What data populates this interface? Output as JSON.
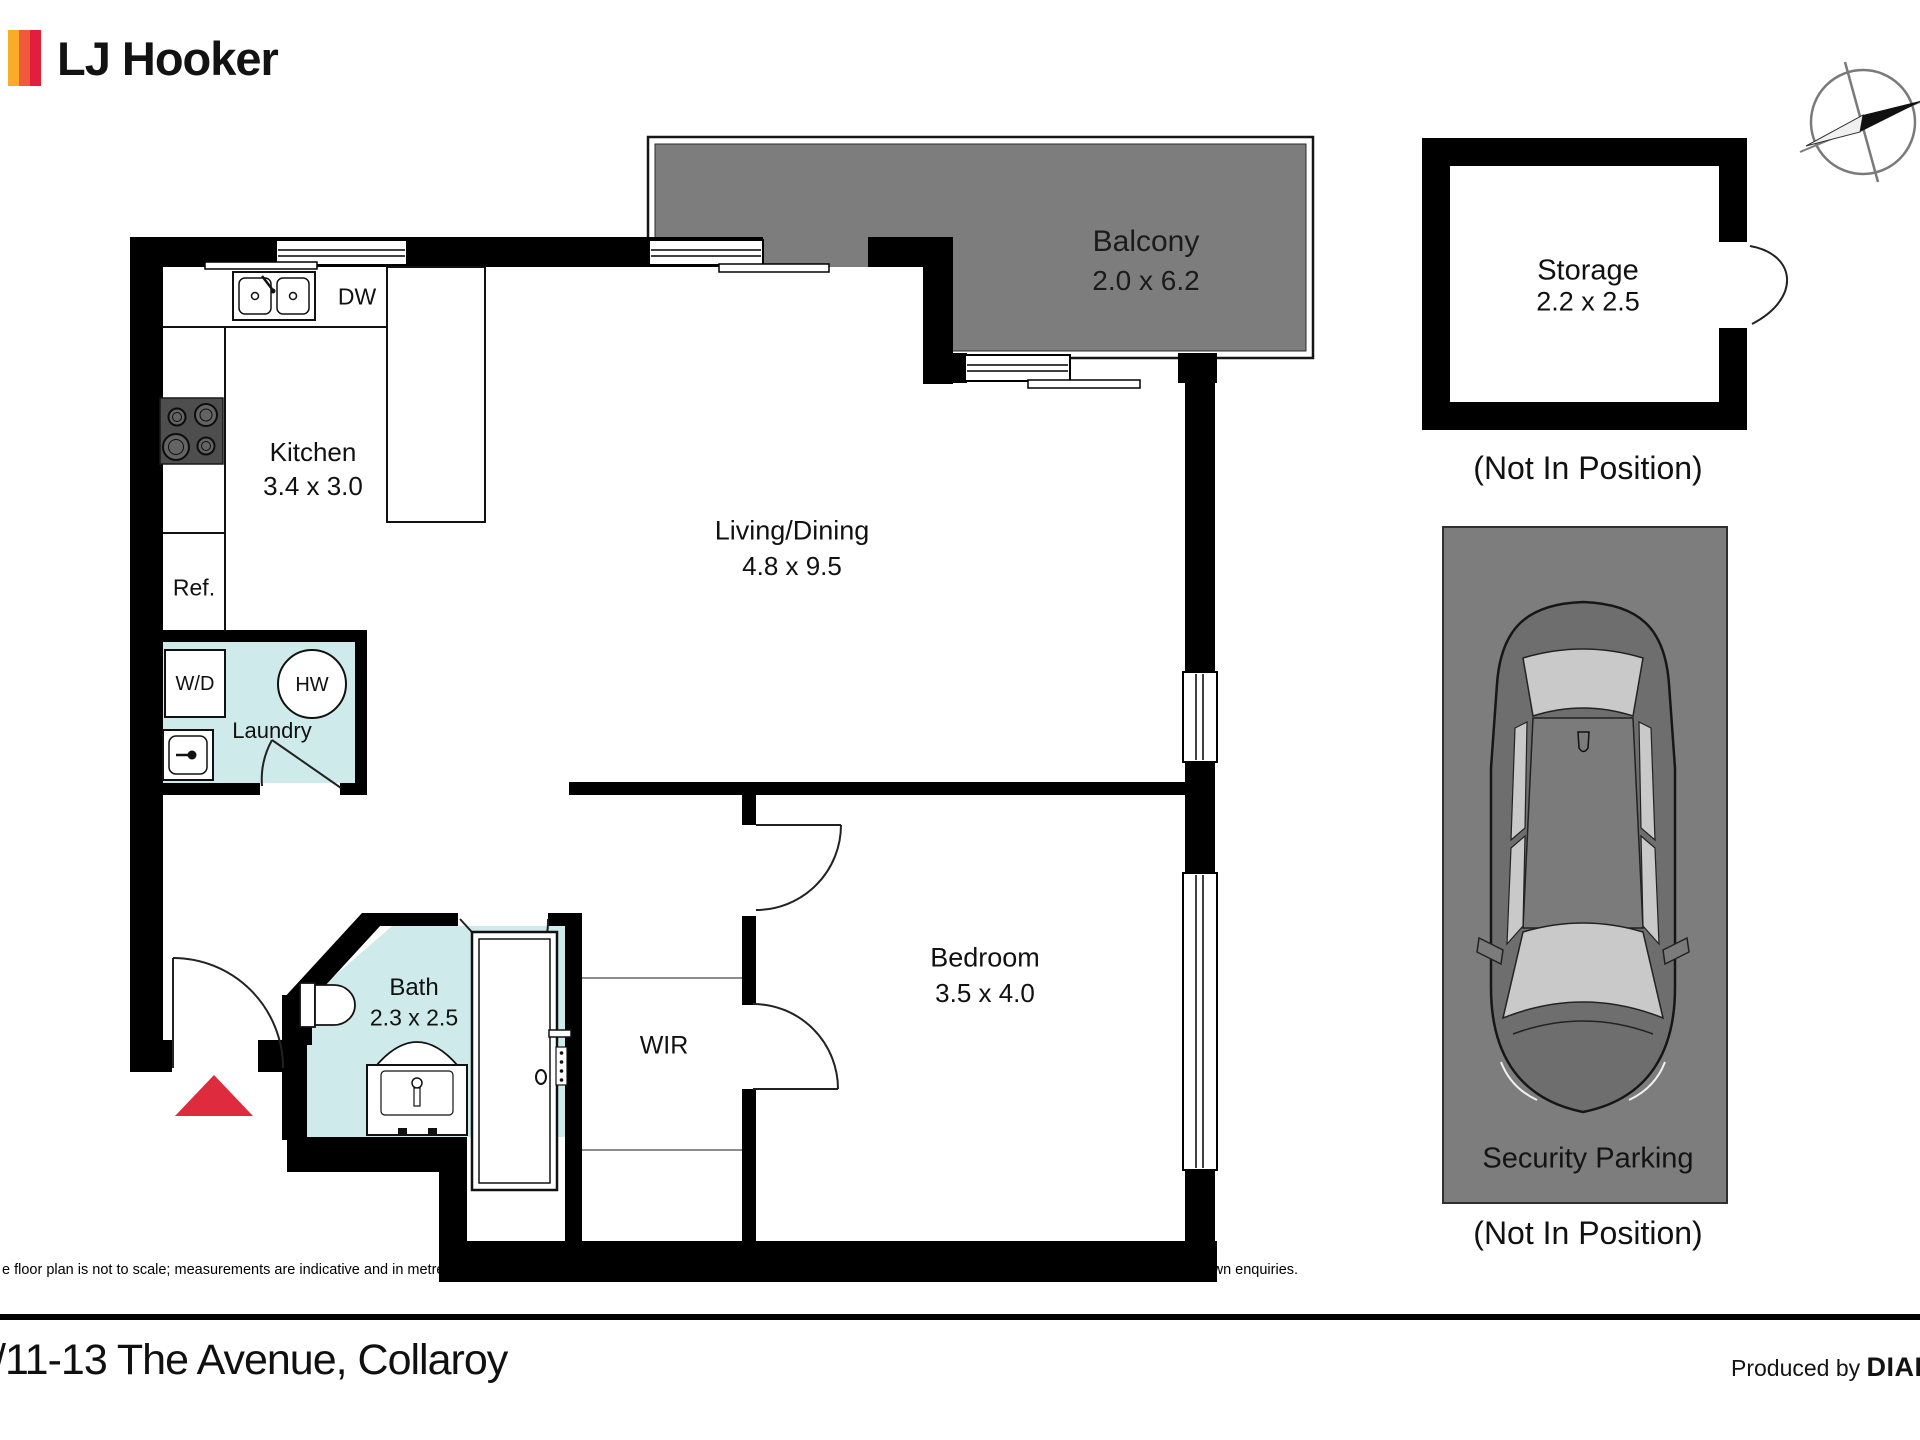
{
  "header": {
    "brand": "LJ Hooker"
  },
  "plan": {
    "rooms": {
      "balcony": {
        "name": "Balcony",
        "dims": "2.0 x 6.2"
      },
      "living": {
        "name": "Living/Dining",
        "dims": "4.8 x 9.5"
      },
      "kitchen": {
        "name": "Kitchen",
        "dims": "3.4 x 3.0"
      },
      "bedroom": {
        "name": "Bedroom",
        "dims": "3.5 x 4.0"
      },
      "bath": {
        "name": "Bath",
        "dims": "2.3 x 2.5"
      },
      "wir": {
        "name": "WIR"
      },
      "laundry": {
        "name": "Laundry"
      }
    },
    "fixtures": {
      "dishwasher": "DW",
      "fridge": "Ref.",
      "washer_dryer": "W/D",
      "hot_water": "HW"
    }
  },
  "annex": {
    "storage": {
      "name": "Storage",
      "dims": "2.2 x 2.5",
      "note": "(Not In Position)"
    },
    "parking": {
      "name": "Security Parking",
      "note": "(Not In Position)"
    }
  },
  "footer": {
    "disclaimer": "e floor plan is not to scale; measurements are indicative and in metres. Exterior elements are not in position. Plans should not be relied on. Interested parties should make and rely on their own enquiries.",
    "address": "/11-13 The Avenue, Collaroy",
    "produced_by": "Produced by",
    "producer": "DIAKRIT"
  },
  "colors": {
    "stripe_yellow": "#F8AC28",
    "stripe_orange": "#F05A3A",
    "stripe_red": "#E31E3C",
    "balcony_gray": "#7d7d7d",
    "wet_area_teal": "#cfeaea",
    "entry_arrow_red": "#df2b3e"
  }
}
